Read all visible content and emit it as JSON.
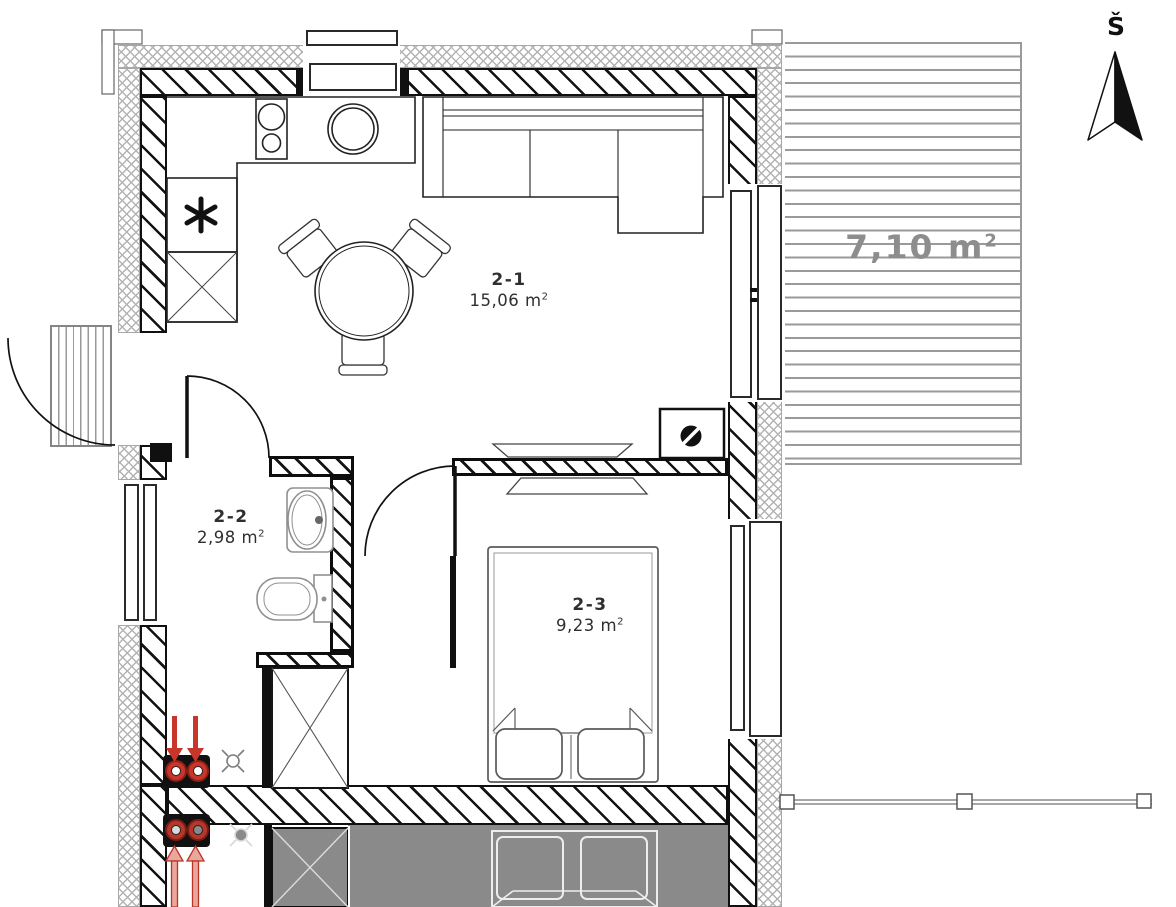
{
  "compass": {
    "label": "Š"
  },
  "rooms": [
    {
      "id": "2-1",
      "area_value": "15,06",
      "area_unit": "m",
      "area_exp": "2"
    },
    {
      "id": "2-2",
      "area_value": "2,98",
      "area_unit": "m",
      "area_exp": "2"
    },
    {
      "id": "2-3",
      "area_value": "9,23",
      "area_unit": "m",
      "area_exp": "2"
    }
  ],
  "terrace": {
    "area_value": "7,10",
    "area_unit": "m",
    "area_exp": "2"
  },
  "icons": {
    "north_arrow": "compass-north-arrow",
    "boiler": "asterisk-symbol",
    "stove": "two-burner-hob",
    "kitchen_sink": "round-sink",
    "bathroom_sink": "oval-washbasin",
    "toilet": "toilet",
    "wardrobe": "crossed-box",
    "electrical_box": "half-filled-circle-box",
    "heating_pipes": "red-twin-pipes-with-arrows",
    "vent": "fan-cross-symbol"
  },
  "colors": {
    "wall": "#101010",
    "insulation": "#b3b3b3",
    "deck_line": "#9a9a9a",
    "terrace_label": "#8d8d8d",
    "neighbor_fill": "#8a8a8a",
    "accent_red": "#c8352b",
    "label_text": "#2f2f2f"
  }
}
